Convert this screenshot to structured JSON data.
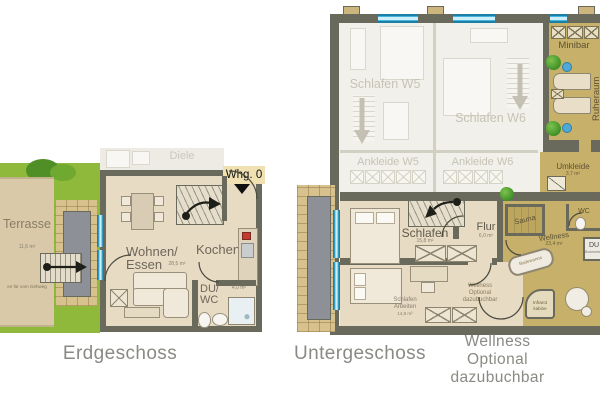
{
  "colors": {
    "wall": "#6A6A5C",
    "floor_beige": "#E8DBC4",
    "faded_floor": "#F2F0EA",
    "wellness_gold": "#C6B06A",
    "lawn_green": "#8FB93B",
    "terrace_tan": "#D9C9A9",
    "brick": "#D7C28E",
    "window_blue": "#2D9FCB",
    "caption_grey": "#8A8A84"
  },
  "erdgeschoss": {
    "caption": "Erdgeschoss",
    "whg_label": "Whg. 0",
    "diele": "Diele",
    "terrasse": "Terrasse",
    "terrasse_area": "11,6 m²",
    "terrasse_note": "en für vorn Gehweg",
    "wohnen1": "Wohnen/",
    "wohnen2": "Essen",
    "wohnen_area": "28,5 m²",
    "kochen": "Kochen",
    "du1": "DU/",
    "du2": "WC",
    "du_area": "4,0 m²"
  },
  "untergeschoss": {
    "caption": "Untergeschoss",
    "note1": "Wellness",
    "note2": "Optional",
    "note3": "dazubuchbar",
    "schlafen_w5": "Schlafen W5",
    "schlafen_w6": "Schlafen W6",
    "ankleide_w5": "Ankleide W5",
    "ankleide_w6": "Ankleide W6",
    "minibar": "Minibar",
    "ruheraum": "Ruheraum",
    "umkleide": "Umkleide",
    "umkleide_area": "3,7 m²",
    "schlafen": "Schlafen",
    "schlafen_area": "15,8 m²",
    "flur": "Flur",
    "flur_area": "6,0 m²",
    "arbeiten1": "Schlafen",
    "arbeiten2": "Arbeiten",
    "arbeiten_area": "14,9 m²",
    "opt1": "Wellness",
    "opt2": "Optional",
    "opt3": "dazubuchbar",
    "sauna": "Sauna",
    "wellness": "Wellness",
    "wellness_area": "23,4 m²",
    "badewanne": "Badewanne",
    "infrarot1": "Infrarot",
    "infrarot2": "kabine",
    "wc": "WC",
    "du": "DU",
    "du_sub": "Bodenebene"
  }
}
